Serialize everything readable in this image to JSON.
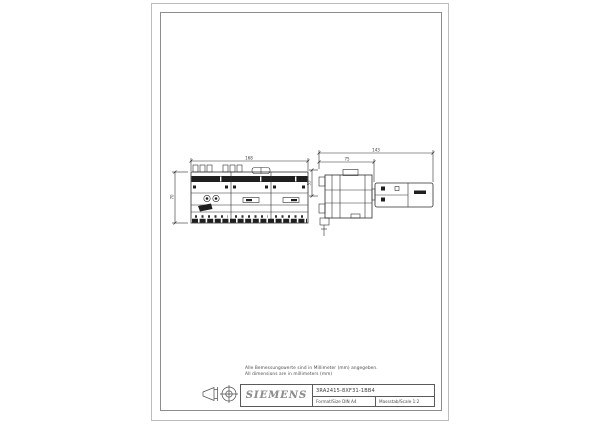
{
  "notes": {
    "line1": "Alle Bemessungswerte sind in Millimeter (mm) angegeben.",
    "line2": "All dimensions are in millimeters (mm)"
  },
  "title_block": {
    "brand": "SIEMENS",
    "part_number": "3RA2415-8XF31-1BB4",
    "format": "Format/Size DIN A4",
    "scale": "Massstab/Scale 1:2"
  },
  "dimensions": {
    "front_width": "168",
    "front_height": "70",
    "side_overall": "143",
    "side_body": "75",
    "side_top": "35"
  },
  "colors": {
    "line": "#2e2e2e",
    "fill_dark": "#1f1f1f",
    "frame_outer": "#bcbcbc",
    "frame_inner": "#8d8d8d"
  }
}
